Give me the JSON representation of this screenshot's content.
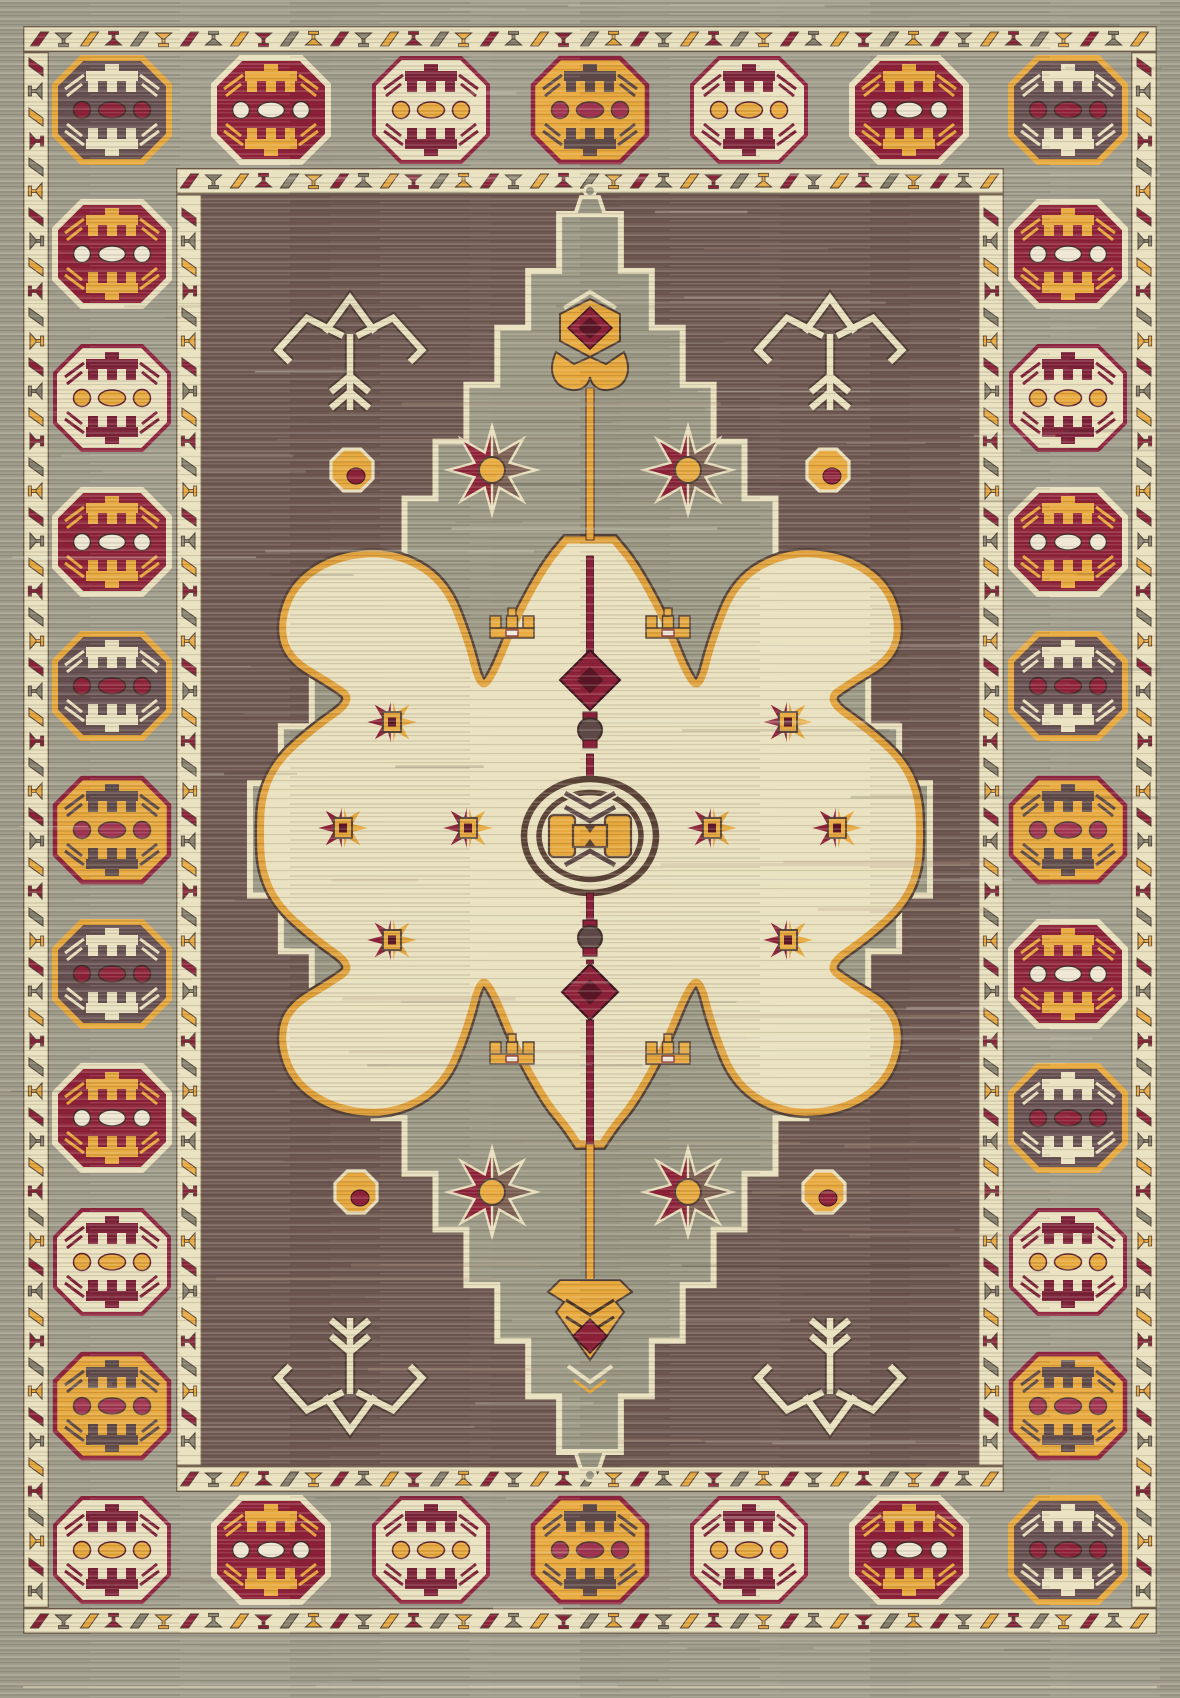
{
  "meta": {
    "title": "Oriental medallion area rug photo",
    "description": "Machine-woven oriental rug: grey striated ground, borders of octagonal gul motifs in burgundy, gold, cream and plum between cream zigzag guard bands; plum-brown inner field with a stepped grey lozenge, a cream central medallion with gold scrolled outline, a central oval emblem, gold tulip pendants on the vertical axis and scattered star flowers.",
    "image_width": 1180,
    "image_height": 1697
  },
  "palette": {
    "border_ground": "#a09d8d",
    "field_ground": "#6f5852",
    "diamond_ground": "#9a9885",
    "cream": "#e9e1bf",
    "cream_bright": "#f2edda",
    "gold": "#e8a93e",
    "gold_dark": "#b97f28",
    "burgundy": "#8e2139",
    "burgundy_dark": "#5a1526",
    "plum": "#665052",
    "outline_dark": "#4f3e37",
    "guard_gray": "#85826f",
    "ring_brown": "#5a4237"
  },
  "border": {
    "guard_motif_colors": [
      "#8e2139",
      "#85826f",
      "#e8a93e"
    ],
    "gul_variants": {
      "cream": {
        "border": "#8f2440",
        "bw": 4,
        "fill": "#eae2c0",
        "motif": "#7c2038",
        "dots": "#e8a93e",
        "dot_stroke": "#5a1f2e"
      },
      "red": {
        "border": "#e9e1bf",
        "bw": 6,
        "fill": "#8e2139",
        "motif": "#e8a93e",
        "dots": "#efe8d4",
        "dot_stroke": "#3f2c28"
      },
      "gold": {
        "border": "#8f2440",
        "bw": 4.5,
        "fill": "#e8a93e",
        "motif": "#5f4a49",
        "dots": "#a23552",
        "dot_stroke": "#4f3e37"
      },
      "brown": {
        "border": "#e8a93e",
        "bw": 6,
        "fill": "#665052",
        "motif": "#eae2c0",
        "dots": "#8e2139",
        "dot_stroke": "#3f2c28"
      }
    },
    "top_row": {
      "y": 110,
      "x_positions": [
        112,
        271,
        431,
        590,
        749,
        909,
        1068
      ],
      "variants": [
        "brown",
        "red",
        "cream",
        "gold",
        "cream",
        "red",
        "brown"
      ]
    },
    "bottom_row": {
      "y": 1550,
      "x_positions": [
        112,
        271,
        431,
        590,
        749,
        909,
        1068
      ],
      "variants": [
        "cream",
        "red",
        "cream",
        "gold",
        "cream",
        "red",
        "brown"
      ]
    },
    "left_column": {
      "x": 112,
      "y_positions": [
        254,
        398,
        542,
        686,
        830,
        974,
        1118,
        1262,
        1406
      ],
      "variants": [
        "red",
        "cream",
        "red",
        "brown",
        "gold",
        "brown",
        "red",
        "cream",
        "gold"
      ]
    },
    "right_column": {
      "x": 1068,
      "y_positions": [
        254,
        398,
        542,
        686,
        830,
        974,
        1118,
        1262,
        1406
      ],
      "variants": [
        "red",
        "cream",
        "red",
        "brown",
        "gold",
        "red",
        "brown",
        "cream",
        "gold"
      ]
    }
  },
  "field": {
    "motifs": [
      {
        "type": "star-flower",
        "x": 492,
        "y": 470
      },
      {
        "type": "star-flower",
        "x": 688,
        "y": 470
      },
      {
        "type": "star-flower",
        "x": 492,
        "y": 1192
      },
      {
        "type": "star-flower",
        "x": 688,
        "y": 1192
      },
      {
        "type": "gold-dot",
        "x": 352,
        "y": 470
      },
      {
        "type": "gold-dot",
        "x": 828,
        "y": 470
      },
      {
        "type": "gold-dot",
        "x": 356,
        "y": 1192
      },
      {
        "type": "gold-dot",
        "x": 824,
        "y": 1192
      },
      {
        "type": "arrow",
        "x": 350,
        "y": 348,
        "flip": 1
      },
      {
        "type": "arrow",
        "x": 830,
        "y": 348,
        "flip": 1
      },
      {
        "type": "arrow",
        "x": 350,
        "y": 1380,
        "flip": -1
      },
      {
        "type": "arrow",
        "x": 830,
        "y": 1380,
        "flip": -1
      }
    ]
  },
  "medallion": {
    "emblem": {
      "cx": 590,
      "cy": 836
    },
    "inner_motifs": [
      {
        "type": "star",
        "x": 392,
        "y": 722
      },
      {
        "type": "star",
        "x": 788,
        "y": 722
      },
      {
        "type": "star",
        "x": 343,
        "y": 828
      },
      {
        "type": "star",
        "x": 468,
        "y": 828
      },
      {
        "type": "star",
        "x": 712,
        "y": 828
      },
      {
        "type": "star",
        "x": 837,
        "y": 828
      },
      {
        "type": "star",
        "x": 392,
        "y": 940
      },
      {
        "type": "star",
        "x": 788,
        "y": 940
      },
      {
        "type": "castle",
        "x": 512,
        "y": 622
      },
      {
        "type": "castle",
        "x": 668,
        "y": 622
      },
      {
        "type": "castle",
        "x": 512,
        "y": 1048
      },
      {
        "type": "castle",
        "x": 668,
        "y": 1048
      }
    ]
  }
}
